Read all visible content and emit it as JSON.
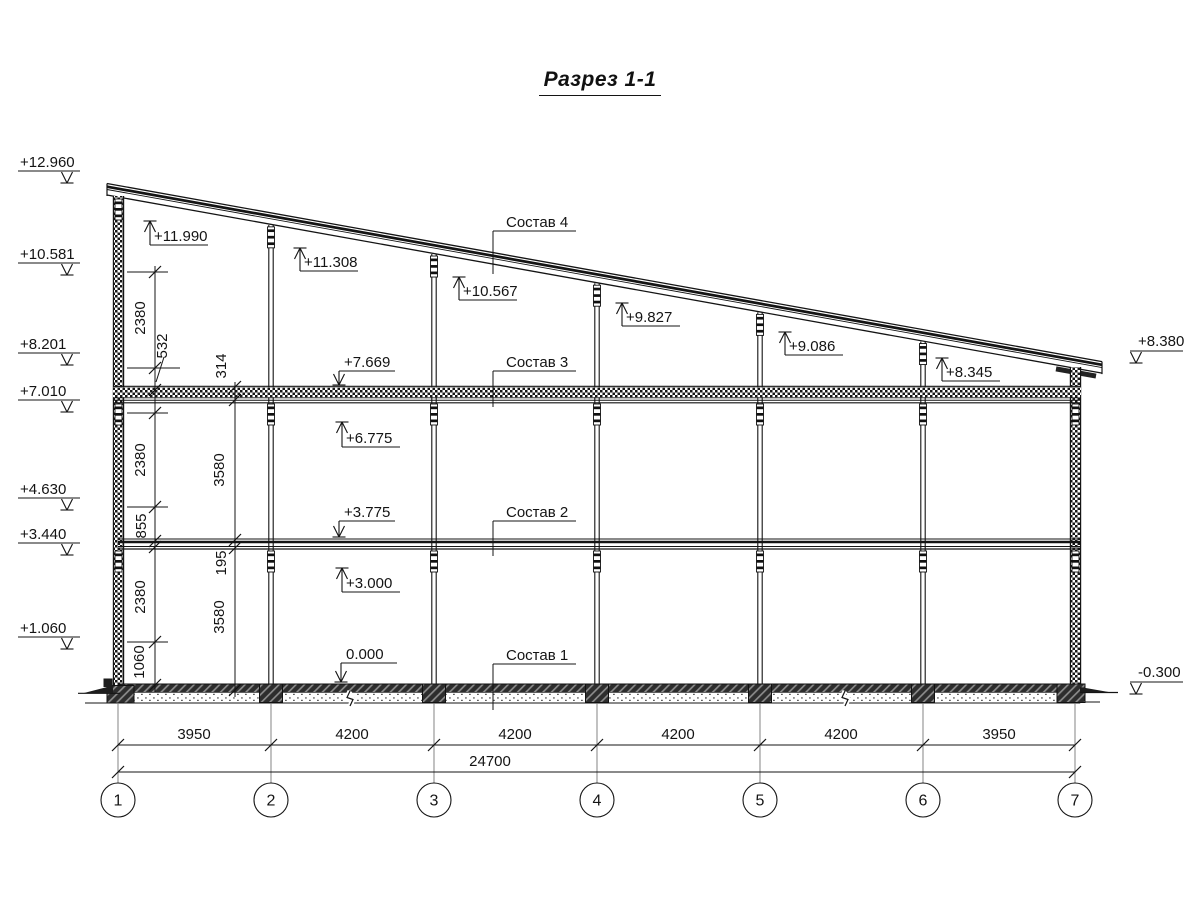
{
  "title": {
    "text": "Разрез 1-1"
  },
  "colors": {
    "ink": "#141414",
    "grid": "#767676",
    "dark_fill": "#1d1d1d"
  },
  "section_labels": [
    {
      "text": "Состав 4",
      "x": 506,
      "text_y": 227,
      "line_x1": 493,
      "line_x2": 576,
      "line_y": 231,
      "leader_x": 493,
      "leader_y2": 274
    },
    {
      "text": "Состав 3",
      "x": 506,
      "text_y": 367,
      "line_x1": 493,
      "line_x2": 576,
      "line_y": 371,
      "leader_x": 493,
      "leader_y2": 407
    },
    {
      "text": "Состав 2",
      "x": 506,
      "text_y": 517,
      "line_x1": 493,
      "line_x2": 576,
      "line_y": 521,
      "leader_x": 493,
      "leader_y2": 556
    },
    {
      "text": "Состав 1",
      "x": 506,
      "text_y": 660,
      "line_x1": 493,
      "line_x2": 576,
      "line_y": 664,
      "leader_x": 493,
      "leader_y2": 710
    }
  ],
  "elevation_marks": {
    "left": [
      [
        "+12.960",
        171
      ],
      [
        "+10.581",
        263
      ],
      [
        "+8.201",
        353
      ],
      [
        "+7.010",
        400
      ],
      [
        "+4.630",
        498
      ],
      [
        "+3.440",
        543
      ],
      [
        "+1.060",
        637
      ]
    ],
    "right": [
      [
        "+8.380",
        351
      ],
      [
        "-0.300",
        682
      ]
    ],
    "up": [
      [
        "+11.990",
        150,
        245,
        221
      ],
      [
        "+11.308",
        300,
        271,
        248
      ],
      [
        "+10.567",
        459,
        300,
        277
      ],
      [
        "+9.827",
        622,
        326,
        303
      ],
      [
        "+9.086",
        785,
        355,
        332
      ],
      [
        "+8.345",
        942,
        381,
        358
      ],
      [
        "+6.775",
        342,
        447,
        422
      ],
      [
        "+3.000",
        342,
        592,
        568
      ]
    ],
    "down": [
      [
        "+7.669",
        339,
        371,
        385
      ],
      [
        "+3.775",
        339,
        521,
        537
      ],
      [
        "0.000",
        341,
        663,
        682
      ]
    ]
  },
  "vertical_dims": {
    "chains": [
      {
        "x": 155,
        "y1": 266,
        "y2": 692,
        "ticks": [
          272,
          368,
          390,
          413,
          507,
          541,
          547,
          642,
          685
        ],
        "labels": [
          [
            "2380",
            145,
            318
          ],
          [
            "532",
            167,
            346
          ],
          [
            "2380",
            145,
            460
          ],
          [
            "855",
            146,
            526
          ],
          [
            "2380",
            145,
            597
          ],
          [
            "1060",
            144,
            662
          ]
        ],
        "leader": [
          164,
          357,
          156,
          382
        ]
      },
      {
        "x": 235,
        "y1": 382,
        "y2": 697,
        "ticks": [
          387,
          400,
          540,
          548,
          690
        ],
        "labels": [
          [
            "314",
            226,
            366
          ],
          [
            "3580",
            224,
            470
          ],
          [
            "195",
            226,
            563
          ],
          [
            "3580",
            224,
            617
          ]
        ]
      }
    ],
    "ext_lines": [
      [
        127,
        272,
        168
      ],
      [
        127,
        368,
        180
      ],
      [
        127,
        413,
        168
      ],
      [
        127,
        507,
        168
      ],
      [
        127,
        642,
        168
      ]
    ]
  },
  "grid": {
    "axes": [
      [
        "1",
        118
      ],
      [
        "2",
        271
      ],
      [
        "3",
        434
      ],
      [
        "4",
        597
      ],
      [
        "5",
        760
      ],
      [
        "6",
        923
      ],
      [
        "7",
        1075
      ]
    ],
    "axis_line_y1": 703,
    "axis_line_y2": 783,
    "bubble_y": 800,
    "bubble_r": 17,
    "dim1": {
      "y": 745,
      "labels": [
        [
          "3950",
          194
        ],
        [
          "4200",
          352
        ],
        [
          "4200",
          515
        ],
        [
          "4200",
          678
        ],
        [
          "4200",
          841
        ],
        [
          "3950",
          999
        ]
      ]
    },
    "dim2": {
      "y": 772,
      "label": "24700",
      "label_x": 490
    }
  },
  "structure": {
    "roof": {
      "x1": 107,
      "x2": 1102,
      "y1": 183.5,
      "slope": 0.179,
      "offsets": [
        [
          0,
          1.3
        ],
        [
          3.2,
          2.7
        ],
        [
          6,
          0.9
        ],
        [
          11.5,
          1.3
        ]
      ]
    },
    "walls": [
      {
        "x": 113.4,
        "w": 10.2,
        "y1": 196,
        "y2": 686
      },
      {
        "x": 1070.4,
        "w": 10.2,
        "y1": 367,
        "y2": 686
      }
    ],
    "columns_x": [
      271,
      434,
      597,
      760,
      923
    ],
    "col_base_y": 684,
    "floor3": {
      "x1": 113,
      "x2": 1081,
      "top": 386.3,
      "checker_y": 387.2,
      "checker_h": 10,
      "lines": [
        [
          397.8,
          0.9
        ],
        [
          400.3,
          1
        ],
        [
          402.8,
          1.2
        ]
      ]
    },
    "floor2": {
      "x1": 118,
      "x2": 1080,
      "lines": [
        [
          539,
          1
        ],
        [
          542,
          2.6
        ],
        [
          546.5,
          1
        ],
        [
          549,
          1.2
        ]
      ]
    },
    "slab": {
      "dark": [
        120,
        684,
        962,
        8.5
      ],
      "screed": [
        134,
        692.5,
        946,
        10.5
      ],
      "bottom_line": [
        85,
        703,
        1080
      ]
    },
    "footings": {
      "cols_w": 23,
      "cols_h": 18.5,
      "left": [
        107,
        685.5,
        27,
        17.5
      ],
      "right": [
        1057,
        684,
        28,
        18.5
      ]
    },
    "breaks_x": [
      350,
      845
    ],
    "ground_left": {
      "line": [
        78,
        693.3,
        120
      ],
      "wedge": "84,693 113,685.5 113,693",
      "plinth": [
        103.5,
        678.5,
        9,
        8.5
      ]
    },
    "ground_right": {
      "line": [
        1080,
        692.5,
        1118
      ],
      "wedge": "1080,687 1110,692.3 1080,692.3",
      "stub": [
        1085,
        702,
        1100
      ]
    },
    "connectors": {
      "members": [
        118.5,
        271,
        434,
        597,
        760,
        923,
        1075.5
      ],
      "floor3_y": 404,
      "floor2_y": 551,
      "wall_top": [
        118.5,
        199
      ]
    }
  }
}
